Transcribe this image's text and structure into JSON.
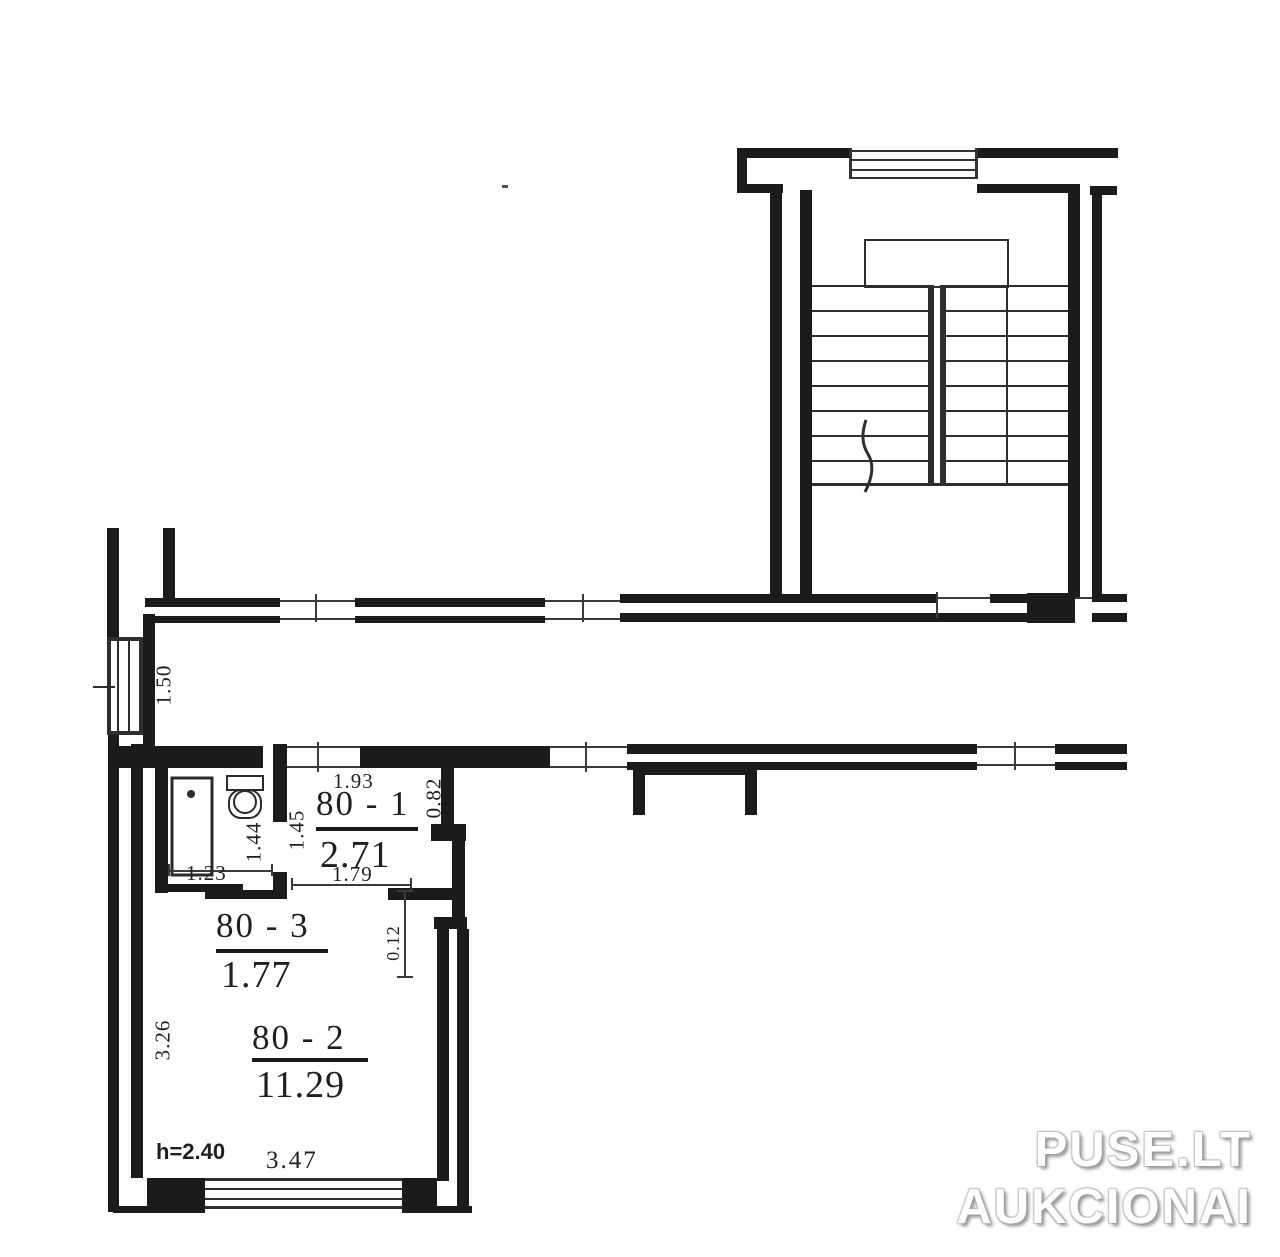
{
  "document": {
    "type": "apartment floor plan"
  },
  "rooms": {
    "r80_1": {
      "number": "80 - 1",
      "area": "2.71"
    },
    "r80_2": {
      "number": "80 - 2",
      "area": "11.29"
    },
    "r80_3": {
      "number": "80 - 3",
      "area": "1.77"
    }
  },
  "dimensions": {
    "hall_top_width": "1.93",
    "hall_right_height": "0.82",
    "hall_left_height": "1.45",
    "bath_right_height": "1.44",
    "bath_width": "1.23",
    "hall_bottom_width": "1.79",
    "wall_jog": "0.12",
    "room_left_height": "3.26",
    "room_bottom_width": "3.47",
    "ceiling_height": "h=2.40",
    "corridor_window_width": "1.50"
  },
  "watermark": {
    "line1": "PUSE.LT",
    "line2": "AUKCIONAI"
  },
  "colors": {
    "wall": "#1b1b1b",
    "thin_line": "#3a3a3a",
    "text": "#1f1f1f",
    "background": "#ffffff",
    "watermark_fill": "#ffffff",
    "watermark_shadow": "#9b9b9b"
  }
}
